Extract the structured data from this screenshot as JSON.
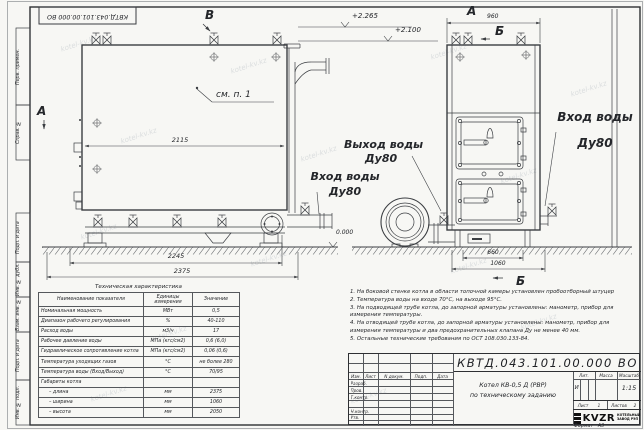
{
  "watermark": "kotel-kv.kz",
  "frame": {
    "top_doc_number": "КВТД.043.101.00.000 ВО",
    "stamps_top": [
      "Перв. примен.",
      "Справ. №"
    ],
    "stamps_bottom": [
      "Подп. и дата",
      "Инв. № дубл.",
      "Взам. инв. №",
      "Подп. и дата",
      "Инв. № подл."
    ],
    "format_label": "Формат",
    "format_value": "А3"
  },
  "views": {
    "marker_view_b": "В",
    "marker_view_a": "А",
    "front_view_label": "А",
    "marker_b_top": "Б",
    "marker_b_bottom": "Б",
    "callout_see_item": "см. п. 1",
    "elev_top": "+2.265",
    "elev_mid": "+2.100",
    "elev_zero": "0.000",
    "dim_2115": "2115",
    "dim_2245": "2245",
    "dim_2375": "2375",
    "dim_960": "960",
    "dim_660": "660",
    "dim_1060": "1060",
    "label_outlet": [
      "Выход воды",
      "Ду80"
    ],
    "label_inlet_left": [
      "Вход воды",
      "Ду80"
    ],
    "label_inlet_right": [
      "Вход воды",
      "Ду80"
    ]
  },
  "spec_table": {
    "title": "Техническая характеристика",
    "headers": [
      "Наименование показателя",
      "Единицы измерения",
      "Значение"
    ],
    "rows": [
      [
        "Номинальная мощность",
        "МВт",
        "0,5"
      ],
      [
        "Диапазон рабочего регулирования",
        "%",
        "40-110"
      ],
      [
        "Расход воды",
        "м3/ч",
        "17"
      ],
      [
        "Рабочее давление воды",
        "МПа (кгс/см2)",
        "0,6 (6,0)"
      ],
      [
        "Гидравлическое сопротивление котла",
        "МПа (кгс/см2)",
        "0,06 (0,6)"
      ],
      [
        "Температура уходящих газов",
        "°С",
        "не более 280"
      ],
      [
        "Температура воды (Вход/Выход)",
        "°С",
        "70/95"
      ],
      [
        "Габариты котла",
        "",
        ""
      ],
      [
        "– длина",
        "мм",
        "2375"
      ],
      [
        "– ширина",
        "мм",
        "1060"
      ],
      [
        "– высота",
        "мм",
        "2050"
      ]
    ]
  },
  "notes": [
    "1. На боковой стенке котла в области топочной камеры установлен пробоотборный штуцер",
    "2. Температура воды на входе 70°С, на выходе 95°С.",
    "3. На подводящей трубе котла, до запорной арматуры установлены: манометр, прибор для измерения температуры.",
    "4. На отводящей трубе котла, до запорной арматуры установлены: манометр, прибор для измерения температуры и два предохранительных клапана Ду не менее 40 мм.",
    "5. Остальные технические требования по ОСТ 108.030.133-84."
  ],
  "title_block": {
    "doc_number": "КВТД.043.101.00.000 ВО",
    "header_cells": [
      "Изм.",
      "Лист",
      "N докум.",
      "Подп.",
      "Дата"
    ],
    "roles": [
      "Разраб.",
      "Пров.",
      "Т.контр.",
      "Н.контр.",
      "Утв."
    ],
    "title_line1": "Котел КВ-0,5 Д (РВР)",
    "title_line2": "по техническому заданию",
    "lit_label": "Лит.",
    "lit_value": "И",
    "mass_label": "Масса",
    "scale_label": "Масштаб",
    "scale_value": "1:15",
    "sheet_label": "Лист",
    "sheet_value": "1",
    "sheets_label": "Листов",
    "sheets_value": "2",
    "logo_text": "KVZR",
    "logo_sub1": "КОТЕЛЬНЫЙ",
    "logo_sub2": "ЗАВОД РЭП"
  }
}
